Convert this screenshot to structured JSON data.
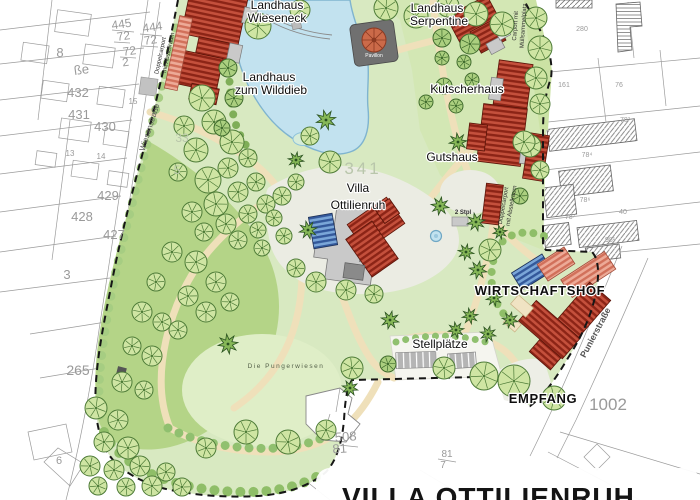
{
  "map": {
    "title": "VILLA OTTILIENRUH",
    "labels": {
      "wieseneck1": "Landhaus",
      "wieseneck2": "Wieseneck",
      "serpentine1": "Landhaus",
      "serpentine2": "Serpentine",
      "wilddieb1": "Landhaus",
      "wilddieb2": "zum Wilddieb",
      "kutscherhaus": "Kutscherhaus",
      "gutshaus": "Gutshaus",
      "villa1": "Villa",
      "villa2": "Ottilienruh",
      "wirtschaftshof": "WIRTSCHAFTSHOF",
      "empfang": "EMPFANG",
      "stellplaetze": "Stellplätze",
      "pavillon": "Pavillon",
      "stpl2": "2 Stpl",
      "pungerwiese": "Die Pungerwiesen",
      "carport1": "Carport mit",
      "carport2": "Müllsammelplatz",
      "doppelcarport1": "Doppelcarport",
      "doppelcarport2": "mit Abstellraum"
    },
    "streets": {
      "wiesenstrasse": "Wiesenstraße",
      "punierstrasse": "Punierstraße"
    },
    "parcels": {
      "n445": "445",
      "n444": "444",
      "n72": "72",
      "n2": "2",
      "n8": "8",
      "sse": "ße",
      "n432": "432",
      "n431": "431",
      "n430": "430",
      "n15": "15",
      "n13": "13",
      "n14": "14",
      "n429": "429",
      "n428": "428",
      "n427": "427",
      "n3": "3",
      "n265": "265",
      "n6": "6",
      "n33": "33",
      "n5": "5",
      "n341": "341",
      "n508": "508",
      "n81": "81",
      "n7": "7",
      "n1002": "1002",
      "n280": "280",
      "n161": "161",
      "n76": "76",
      "n78_3": "78³",
      "n78_4": "78⁴",
      "n78_6": "78⁶",
      "n78_7": "78⁷",
      "n98_1": "98¹",
      "n40": "40"
    },
    "colors": {
      "roof_red": "#b03626",
      "roof_light": "#edaa97",
      "roof_blue": "#7aa6d8",
      "park_green": "#d8e9c1",
      "lawn_dark": "#b4d487",
      "pond_blue": "#c2e2ef",
      "path_tan": "#f0e2bd"
    }
  }
}
